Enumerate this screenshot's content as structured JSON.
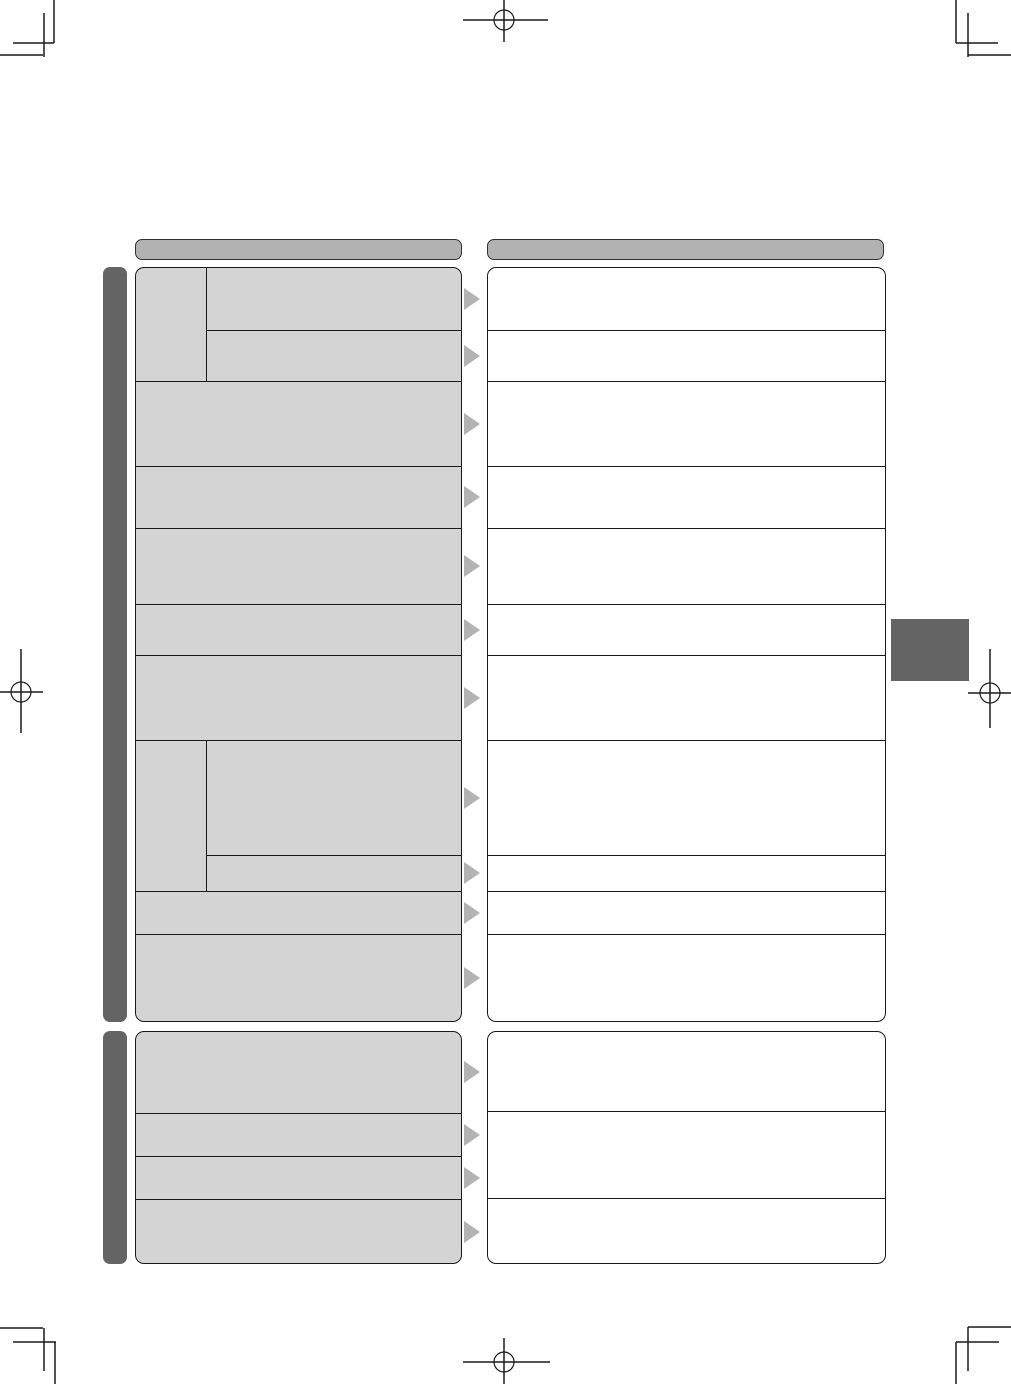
{
  "page": {
    "kind": "printed-manual-troubleshooting-template",
    "visible_text": "",
    "background": "#ffffff"
  },
  "palette": {
    "line": "#1a1a1a",
    "panel_gray": "#d4d4d4",
    "panel_white": "#ffffff",
    "header_gray": "#b2b2b2",
    "section_bar_gray": "#646464",
    "arrow_gray": "#b3b3b3",
    "crop_mark": "#1a1a1a"
  },
  "icons": {
    "row_pointer": "right-triangle",
    "corner_marks": "trim-mark",
    "center_marks": "registration-crosshair-circle"
  },
  "columns": {
    "left": {
      "header_label": "",
      "groups": [
        {
          "rows": [
            {
              "kind": "split",
              "side_label": "",
              "height": 114,
              "sub_rows": [
                {
                  "height": 63,
                  "label": ""
                },
                {
                  "height": 51,
                  "label": ""
                }
              ]
            },
            {
              "kind": "plain",
              "height": 85,
              "label": ""
            },
            {
              "kind": "plain",
              "height": 62,
              "label": ""
            },
            {
              "kind": "plain",
              "height": 76,
              "label": ""
            },
            {
              "kind": "plain",
              "height": 51,
              "label": ""
            },
            {
              "kind": "plain",
              "height": 85,
              "label": ""
            },
            {
              "kind": "split",
              "side_label": "",
              "height": 151,
              "sub_rows": [
                {
                  "height": 115,
                  "label": ""
                },
                {
                  "height": 36,
                  "label": ""
                }
              ]
            },
            {
              "kind": "plain",
              "height": 43,
              "label": ""
            },
            {
              "kind": "plain",
              "height": 87,
              "label": ""
            }
          ]
        },
        {
          "rows": [
            {
              "kind": "plain",
              "height": 82,
              "label": ""
            },
            {
              "kind": "plain",
              "height": 43,
              "label": ""
            },
            {
              "kind": "plain",
              "height": 43,
              "label": ""
            },
            {
              "kind": "plain",
              "height": 65,
              "label": ""
            }
          ]
        }
      ]
    },
    "right": {
      "header_label": "",
      "groups": [
        {
          "cells": [
            {
              "height": 63,
              "label": ""
            },
            {
              "height": 51,
              "label": ""
            },
            {
              "height": 85,
              "label": ""
            },
            {
              "height": 62,
              "label": ""
            },
            {
              "height": 76,
              "label": ""
            },
            {
              "height": 51,
              "label": ""
            },
            {
              "height": 85,
              "label": ""
            },
            {
              "height": 115,
              "label": ""
            },
            {
              "height": 36,
              "label": ""
            },
            {
              "height": 43,
              "label": ""
            },
            {
              "height": 87,
              "label": ""
            }
          ]
        },
        {
          "cells": [
            {
              "height": 80,
              "label": ""
            },
            {
              "height": 87,
              "label": ""
            },
            {
              "height": 66,
              "label": ""
            }
          ]
        }
      ]
    }
  }
}
